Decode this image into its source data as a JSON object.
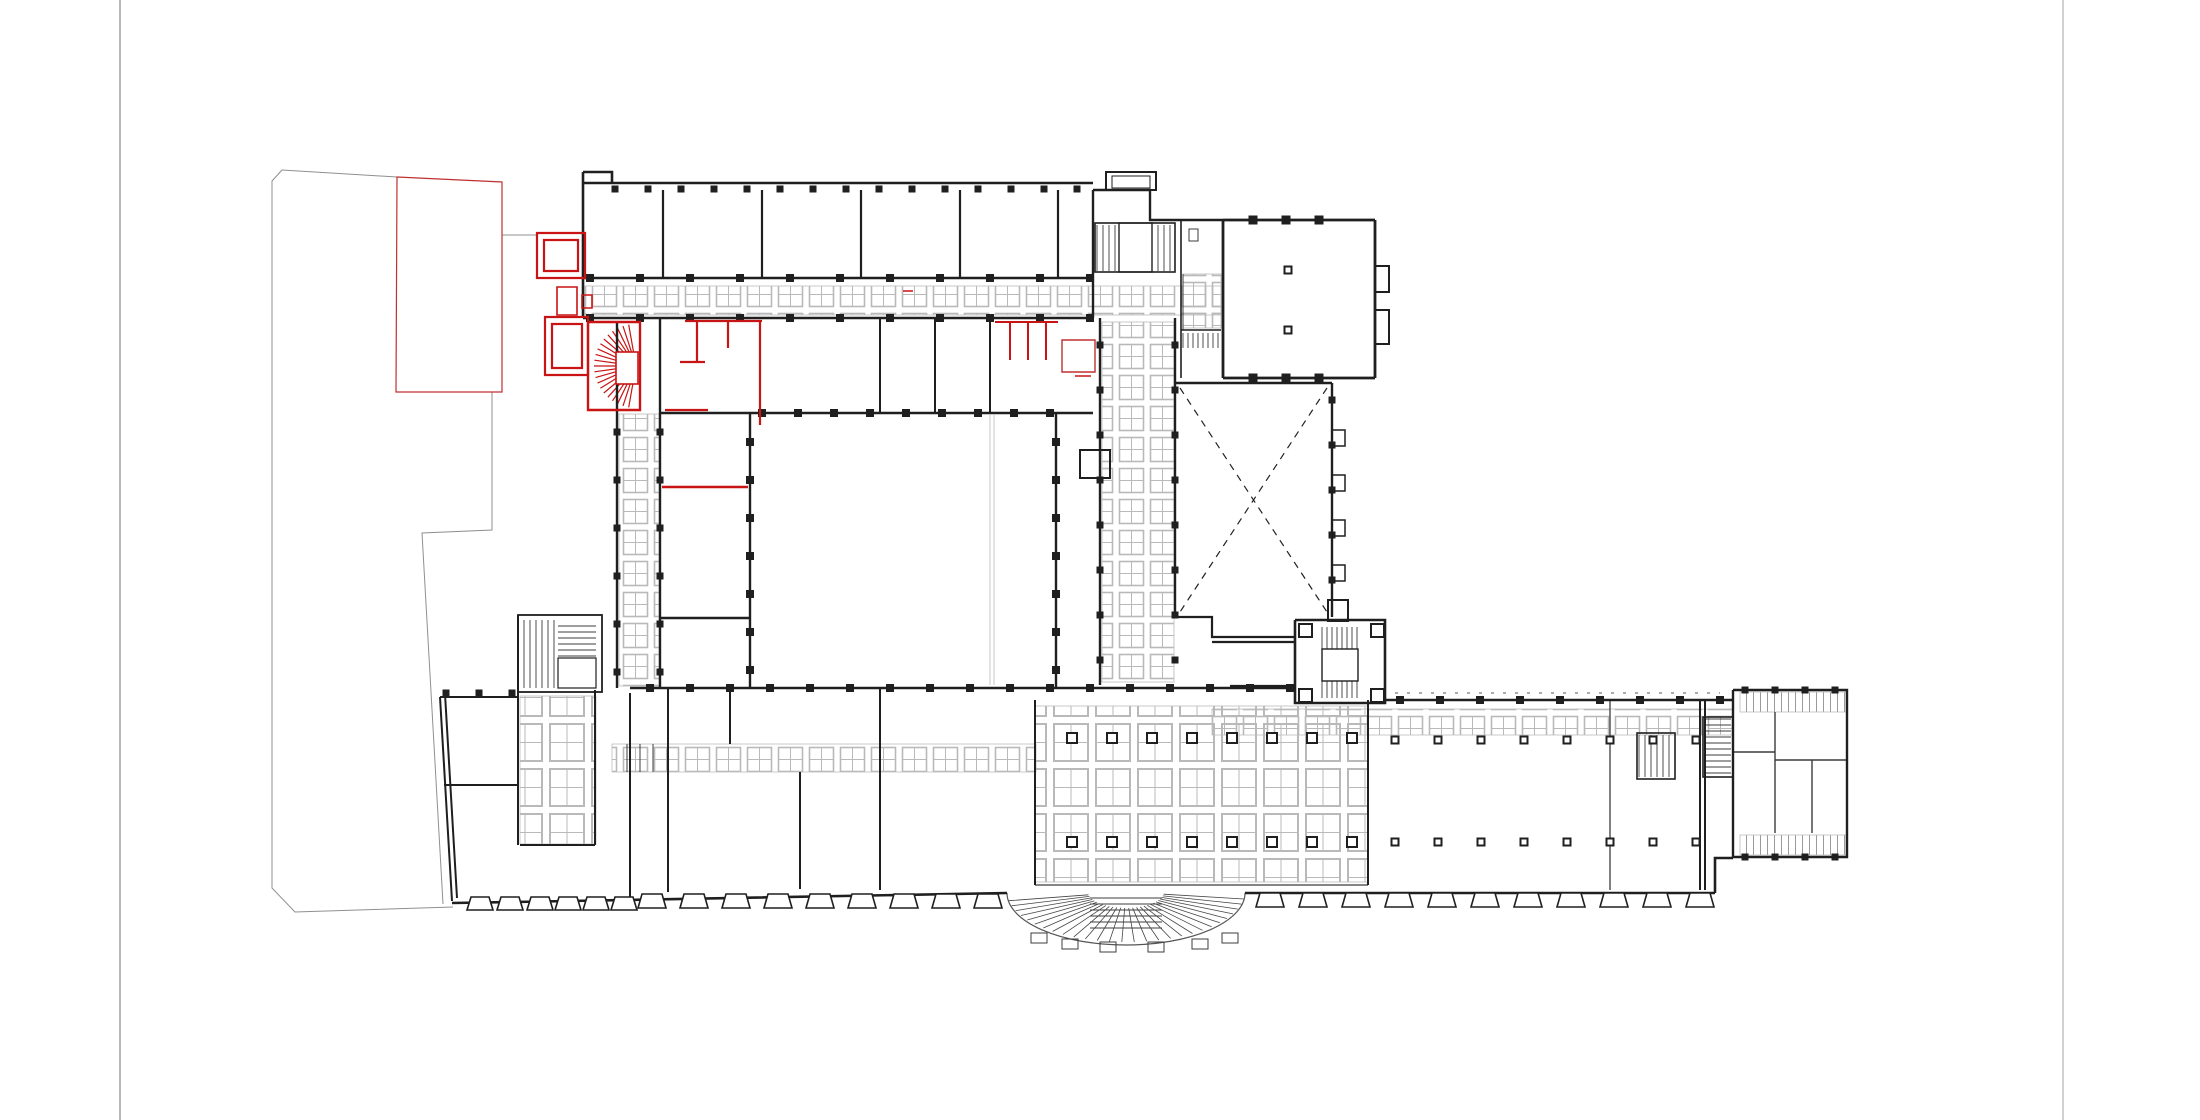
{
  "meta": {
    "drawing_type": "architectural floor plan",
    "description": "Ground floor plan, black existing walls with red intervention overlay",
    "background": "#ffffff"
  },
  "colors": {
    "wall": "#1f1f1f",
    "thin": "#3c3c3c",
    "hatch": "#b9b9b9",
    "red": "#c81414",
    "red_thin": "#c03030",
    "parcel": "#8f8f8f",
    "sheet_left_line": "#9a9a9a",
    "sheet_right_line": "#d2d2d2",
    "courtyard_thin": "#c4c4c4"
  },
  "plan": {
    "viewBox": "0 0 2200 1120",
    "sheet_lines": [
      {
        "d": "M120,0 V1120",
        "stroke": "#9a9a9a",
        "width": 1.4
      },
      {
        "d": "M2063,0 V1120",
        "stroke": "#d2d2d2",
        "width": 2
      }
    ],
    "gray_paths": [
      {
        "d": "M282,170 L272,181 V888 L295,912 L453,907",
        "stroke": "#8f8f8f",
        "width": 1
      },
      {
        "d": "M282,170 L397,177",
        "stroke": "#8f8f8f",
        "width": 1
      },
      {
        "d": "M492,392 V530 L422,533 L443,904",
        "stroke": "#8f8f8f",
        "width": 1
      },
      {
        "d": "M502,235 H537",
        "stroke": "#8f8f8f",
        "width": 1
      },
      {
        "d": "M990,415 V685 M994,415 V685",
        "stroke": "#c4c4c4",
        "width": 1
      },
      {
        "d": "M1007,893 A119,52 0 0 0 1245,893",
        "stroke": "#555555",
        "width": 1.2
      }
    ],
    "wall_paths": [
      {
        "d": "M583,172 H612 V183 M583,172 V318 M583,183 H1093 M583,278 H1093 M583,318 H1093",
        "stroke": "#1f1f1f",
        "width": 2.6
      },
      {
        "d": "M663,190 V278 M762,190 V278 M861,190 V278 M960,190 V278 M1058,190 V278",
        "stroke": "#1f1f1f",
        "width": 2.2
      },
      {
        "d": "M880,318 V413 M935,318 V413 M990,318 V413",
        "stroke": "#1f1f1f",
        "width": 2
      },
      {
        "d": "M660,318 V688 M617,322 V688",
        "stroke": "#1f1f1f",
        "width": 2.4
      },
      {
        "d": "M660,413 H1093 M750,413 V688 M1056,413 V688 M660,618 H750",
        "stroke": "#1f1f1f",
        "width": 2.4
      },
      {
        "d": "M1093,190 V318 M1093,190 H1150 V220 H1223",
        "stroke": "#1f1f1f",
        "width": 2.4
      },
      {
        "d": "M1100,318 V685 M1175,318 V617",
        "stroke": "#1f1f1f",
        "width": 2.4
      },
      {
        "d": "M1223,220 V378 M1223,220 H1375 M1375,220 V378 M1223,378 H1375",
        "stroke": "#1f1f1f",
        "width": 2.8
      },
      {
        "d": "M1175,383 H1332 M1332,383 V617",
        "stroke": "#1f1f1f",
        "width": 2.4
      },
      {
        "d": "M1175,617 H1212 V637 H1295 M1212,642 H1295 M1230,686 H1295",
        "stroke": "#1f1f1f",
        "width": 2.2
      },
      {
        "d": "M1295,620 H1385 V703 H1295 V620",
        "stroke": "#1f1f1f",
        "width": 2.6
      },
      {
        "d": "M630,688 H1295 M1385,700 H1733",
        "stroke": "#1f1f1f",
        "width": 2.6
      },
      {
        "d": "M440,697 H518 M440,697 L452,901 M445,694 L457,898",
        "stroke": "#1f1f1f",
        "width": 2
      },
      {
        "d": "M452,903 C640,900 830,896 1007,893 M1245,893 H1715 M1715,893 V858 H1733",
        "stroke": "#1f1f1f",
        "width": 2.6
      },
      {
        "d": "M1733,690 H1847 V857 H1733 V690",
        "stroke": "#1f1f1f",
        "width": 2.4
      },
      {
        "d": "M630,693 V897 M518,615 V845 M595,690 V845 M520,845 H595 M444,785 H518",
        "stroke": "#1f1f1f",
        "width": 2
      },
      {
        "d": "M668,688 V892 M730,688 V744 M800,772 V889 M880,688 V890",
        "stroke": "#1f1f1f",
        "width": 2
      },
      {
        "d": "M1035,700 V885 M1368,700 V885 M1700,700 V890 M1705,700 V890",
        "stroke": "#1f1f1f",
        "width": 2
      },
      {
        "d": "M1181,220 V378 M1181,330 H1221",
        "stroke": "#1f1f1f",
        "width": 1.6
      }
    ],
    "thin_paths": [
      {
        "d": "M1610,700 V890",
        "stroke": "#3c3c3c",
        "width": 1.3
      },
      {
        "d": "M1035,885 H1368",
        "stroke": "#3c3c3c",
        "width": 1.2
      },
      {
        "d": "M1775,712 V833 M1733,752 H1775 M1775,760 H1847 M1812,760 V833",
        "stroke": "#3c3c3c",
        "width": 1.4
      },
      {
        "d": "M1183,274 V330",
        "stroke": "#3c3c3c",
        "width": 1
      },
      {
        "d": "M627,744 V772 M640,744 V772 M653,744 V772",
        "stroke": "#3c3c3c",
        "width": 1
      }
    ],
    "red_paths": [
      {
        "d": "M537,233 h48 v45 h-48 Z M544,240 h34 v31 h-34 Z",
        "stroke": "#c81414",
        "width": 2.2
      },
      {
        "d": "M557,287 h20 v28 h-20 Z M582,295 h10 v13 h-10 Z",
        "stroke": "#c81414",
        "width": 1.6
      },
      {
        "d": "M545,317 h43 v58 h-43 Z M552,324 h30 v44 h-30 Z",
        "stroke": "#c81414",
        "width": 2.2
      },
      {
        "d": "M588,322 H640 V410 H588 V322",
        "stroke": "#c81414",
        "width": 2.4
      },
      {
        "d": "M697,322 V362 M728,322 V348 M760,322 V425",
        "stroke": "#c81414",
        "width": 2.2
      },
      {
        "d": "M685,321 H762 M665,410 H708 M680,362 H705",
        "stroke": "#c81414",
        "width": 2.2
      },
      {
        "d": "M995,322 H1058 M1010,322 V360 M1028,322 V360 M1046,322 V360",
        "stroke": "#c81414",
        "width": 2
      },
      {
        "d": "M662,487 H748",
        "stroke": "#c81414",
        "width": 2.4
      },
      {
        "d": "M903,291 h10 M1075,376 h16",
        "stroke": "#c81414",
        "width": 1.6
      },
      {
        "d": "M397,177 L502,182 V392 H396 Z",
        "stroke": "#c03030",
        "width": 1.2
      },
      {
        "d": "M1062,340 h33 v32 h-33 Z",
        "stroke": "#c03030",
        "width": 1.4
      }
    ],
    "dashed_paths": [
      {
        "d": "M1180,388 L1327,612 M1327,388 L1180,612",
        "stroke": "#222222",
        "width": 1.2,
        "dash": "7,6"
      },
      {
        "d": "M1395,693 H1720",
        "stroke": "#555555",
        "width": 1,
        "dash": "3,9"
      }
    ],
    "hatch_areas": [
      {
        "x": 585,
        "y": 286,
        "w": 636,
        "h": 29,
        "pattern": "cells"
      },
      {
        "x": 619,
        "y": 414,
        "w": 40,
        "h": 272,
        "pattern": "cells"
      },
      {
        "x": 1102,
        "y": 322,
        "w": 72,
        "h": 360,
        "pattern": "cells"
      },
      {
        "x": 1183,
        "y": 274,
        "w": 38,
        "h": 54,
        "pattern": "cells"
      },
      {
        "x": 612,
        "y": 744,
        "w": 424,
        "h": 28,
        "pattern": "cells"
      },
      {
        "x": 1212,
        "y": 709,
        "w": 521,
        "h": 26,
        "pattern": "cells"
      },
      {
        "x": 1035,
        "y": 706,
        "w": 333,
        "h": 176,
        "pattern": "bigcells"
      },
      {
        "x": 520,
        "y": 696,
        "w": 76,
        "h": 148,
        "pattern": "bigcells"
      },
      {
        "x": 1740,
        "y": 692,
        "w": 106,
        "h": 20,
        "pattern": "vstripes"
      },
      {
        "x": 1740,
        "y": 835,
        "w": 106,
        "h": 20,
        "pattern": "vstripes"
      }
    ],
    "pilaster_rows": [
      {
        "axis": "h",
        "y": 189,
        "from": 615,
        "to": 1085,
        "step": 33,
        "size": 7
      },
      {
        "axis": "h",
        "y": 278,
        "from": 590,
        "to": 1090,
        "step": 50,
        "size": 8
      },
      {
        "axis": "h",
        "y": 318,
        "from": 590,
        "to": 1090,
        "step": 50,
        "size": 8
      },
      {
        "axis": "h",
        "y": 413,
        "from": 762,
        "to": 1050,
        "step": 36,
        "size": 8
      },
      {
        "axis": "v",
        "x": 750,
        "from": 442,
        "to": 672,
        "step": 38,
        "size": 8
      },
      {
        "axis": "v",
        "x": 1056,
        "from": 442,
        "to": 672,
        "step": 38,
        "size": 8
      },
      {
        "axis": "v",
        "x": 617,
        "from": 432,
        "to": 672,
        "step": 48,
        "size": 7
      },
      {
        "axis": "v",
        "x": 660,
        "from": 432,
        "to": 672,
        "step": 48,
        "size": 7
      },
      {
        "axis": "v",
        "x": 1100,
        "from": 345,
        "to": 660,
        "step": 45,
        "size": 7
      },
      {
        "axis": "v",
        "x": 1175,
        "from": 345,
        "to": 660,
        "step": 45,
        "size": 7
      },
      {
        "axis": "h",
        "y": 688,
        "from": 650,
        "to": 1290,
        "step": 40,
        "size": 8
      },
      {
        "axis": "h",
        "y": 700,
        "from": 1400,
        "to": 1720,
        "step": 40,
        "size": 8
      },
      {
        "axis": "h",
        "y": 220,
        "from": 1253,
        "to": 1320,
        "step": 33,
        "size": 9
      },
      {
        "axis": "h",
        "y": 378,
        "from": 1253,
        "to": 1320,
        "step": 33,
        "size": 9
      },
      {
        "axis": "h",
        "y": 690,
        "from": 1745,
        "to": 1835,
        "step": 30,
        "size": 7
      },
      {
        "axis": "h",
        "y": 857,
        "from": 1745,
        "to": 1835,
        "step": 30,
        "size": 7
      },
      {
        "axis": "h",
        "y": 693,
        "from": 446,
        "to": 512,
        "step": 33,
        "size": 7
      },
      {
        "axis": "v",
        "x": 1332,
        "from": 400,
        "to": 600,
        "step": 45,
        "size": 7
      }
    ],
    "columns": [
      {
        "xs": [
          1072,
          1112,
          1152,
          1192,
          1232,
          1272,
          1312,
          1352
        ],
        "ys": [
          738,
          842
        ],
        "size": 10
      },
      {
        "xs": [
          1395,
          1438,
          1481,
          1524,
          1567,
          1610,
          1653,
          1696
        ],
        "ys": [
          740,
          842
        ],
        "size": 7
      },
      {
        "xs": [
          1288
        ],
        "ys": [
          270,
          330
        ],
        "size": 7
      }
    ],
    "buttresses": [
      {
        "xs": [
          480,
          510,
          540,
          568,
          596,
          624
        ],
        "y": 897,
        "w": 18,
        "h": 13
      },
      {
        "xs": [
          652,
          694,
          736,
          778,
          820,
          862,
          904,
          946,
          988
        ],
        "y": 894,
        "w": 20,
        "h": 14
      },
      {
        "xs": [
          1270,
          1313,
          1356,
          1399,
          1442,
          1485,
          1528,
          1571,
          1614,
          1657,
          1700
        ],
        "y": 893,
        "w": 20,
        "h": 14
      }
    ],
    "stairs": [
      {
        "x": 1097,
        "y": 225,
        "w": 22,
        "h": 46,
        "dir": "v",
        "step": 6
      },
      {
        "x": 1152,
        "y": 225,
        "w": 21,
        "h": 46,
        "dir": "v",
        "step": 6
      },
      {
        "x": 1183,
        "y": 333,
        "w": 36,
        "h": 15,
        "dir": "v",
        "step": 5
      },
      {
        "x": 1322,
        "y": 627,
        "w": 36,
        "h": 22,
        "dir": "v",
        "step": 5
      },
      {
        "x": 1322,
        "y": 681,
        "w": 36,
        "h": 17,
        "dir": "v",
        "step": 5
      },
      {
        "x": 524,
        "y": 620,
        "w": 32,
        "h": 68,
        "dir": "v",
        "step": 6
      },
      {
        "x": 558,
        "y": 626,
        "w": 38,
        "h": 30,
        "dir": "h",
        "step": 6
      },
      {
        "x": 1639,
        "y": 735,
        "w": 34,
        "h": 42,
        "dir": "v",
        "step": 6
      },
      {
        "x": 1705,
        "y": 719,
        "w": 26,
        "h": 56,
        "dir": "h",
        "step": 6
      },
      {
        "x": 1090,
        "y": 898,
        "w": 72,
        "h": 34,
        "dir": "h",
        "step": 6
      }
    ],
    "fans": [
      {
        "cx": 636,
        "cy": 366,
        "r0": 4,
        "r1": 42,
        "sx": 1,
        "a0": 100,
        "a1": 260,
        "step": 8,
        "stroke": "#c81414",
        "width": 1.2
      },
      {
        "cx": 1126,
        "cy": 892,
        "r0": 16,
        "r1": 50,
        "sx": 2.38,
        "a0": 8,
        "a1": 172,
        "step": 6,
        "stroke": "#444444",
        "width": 0.8
      }
    ],
    "boxes": [
      {
        "x": 1106,
        "y": 172,
        "w": 50,
        "h": 18,
        "stroke": "#1f1f1f",
        "width": 2
      },
      {
        "x": 1112,
        "y": 176,
        "w": 38,
        "h": 12,
        "stroke": "#1f1f1f",
        "width": 1
      },
      {
        "x": 1080,
        "y": 450,
        "w": 30,
        "h": 28,
        "stroke": "#1f1f1f",
        "width": 2
      },
      {
        "x": 1328,
        "y": 600,
        "w": 20,
        "h": 21,
        "stroke": "#1f1f1f",
        "width": 2
      },
      {
        "x": 1119,
        "y": 223,
        "w": 33,
        "h": 49,
        "stroke": "#1f1f1f",
        "width": 1.4,
        "fill": "#ffffff"
      },
      {
        "x": 1095,
        "y": 223,
        "w": 80,
        "h": 49,
        "stroke": "#1f1f1f",
        "width": 1.6
      },
      {
        "x": 1322,
        "y": 649,
        "w": 36,
        "h": 32,
        "stroke": "#1f1f1f",
        "width": 1.4,
        "fill": "#ffffff"
      },
      {
        "x": 518,
        "y": 615,
        "w": 84,
        "h": 77,
        "stroke": "#1f1f1f",
        "width": 1.8
      },
      {
        "x": 558,
        "y": 658,
        "w": 38,
        "h": 30,
        "stroke": "#1f1f1f",
        "width": 1.2,
        "fill": "#ffffff"
      },
      {
        "x": 1637,
        "y": 733,
        "w": 38,
        "h": 46,
        "stroke": "#1f1f1f",
        "width": 1.6
      },
      {
        "x": 1703,
        "y": 717,
        "w": 30,
        "h": 60,
        "stroke": "#1f1f1f",
        "width": 1.6
      },
      {
        "x": 1189,
        "y": 229,
        "w": 9,
        "h": 12,
        "stroke": "#3c3c3c",
        "width": 1
      },
      {
        "x": 1332,
        "y": 430,
        "w": 13,
        "h": 16,
        "stroke": "#1f1f1f",
        "width": 1.5
      },
      {
        "x": 1332,
        "y": 475,
        "w": 13,
        "h": 16,
        "stroke": "#1f1f1f",
        "width": 1.5
      },
      {
        "x": 1332,
        "y": 520,
        "w": 13,
        "h": 16,
        "stroke": "#1f1f1f",
        "width": 1.5
      },
      {
        "x": 1332,
        "y": 565,
        "w": 13,
        "h": 16,
        "stroke": "#1f1f1f",
        "width": 1.5
      },
      {
        "x": 1375,
        "y": 266,
        "w": 14,
        "h": 26,
        "stroke": "#1f1f1f",
        "width": 2
      },
      {
        "x": 1375,
        "y": 310,
        "w": 14,
        "h": 34,
        "stroke": "#1f1f1f",
        "width": 2
      },
      {
        "x": 1299,
        "y": 624,
        "w": 13,
        "h": 13,
        "stroke": "#1f1f1f",
        "width": 2
      },
      {
        "x": 1371,
        "y": 624,
        "w": 13,
        "h": 13,
        "stroke": "#1f1f1f",
        "width": 2
      },
      {
        "x": 1299,
        "y": 689,
        "w": 13,
        "h": 13,
        "stroke": "#1f1f1f",
        "width": 2
      },
      {
        "x": 1371,
        "y": 689,
        "w": 13,
        "h": 13,
        "stroke": "#1f1f1f",
        "width": 2
      },
      {
        "x": 1031,
        "y": 933,
        "w": 16,
        "h": 10,
        "stroke": "#3c3c3c",
        "width": 1
      },
      {
        "x": 1062,
        "y": 939,
        "w": 16,
        "h": 10,
        "stroke": "#3c3c3c",
        "width": 1
      },
      {
        "x": 1100,
        "y": 942,
        "w": 16,
        "h": 10,
        "stroke": "#3c3c3c",
        "width": 1
      },
      {
        "x": 1148,
        "y": 942,
        "w": 16,
        "h": 10,
        "stroke": "#3c3c3c",
        "width": 1
      },
      {
        "x": 1192,
        "y": 939,
        "w": 16,
        "h": 10,
        "stroke": "#3c3c3c",
        "width": 1
      },
      {
        "x": 1222,
        "y": 933,
        "w": 16,
        "h": 10,
        "stroke": "#3c3c3c",
        "width": 1
      },
      {
        "x": 616,
        "y": 352,
        "w": 22,
        "h": 32,
        "stroke": "#c81414",
        "width": 1.6,
        "fill": "#ffffff"
      }
    ]
  }
}
